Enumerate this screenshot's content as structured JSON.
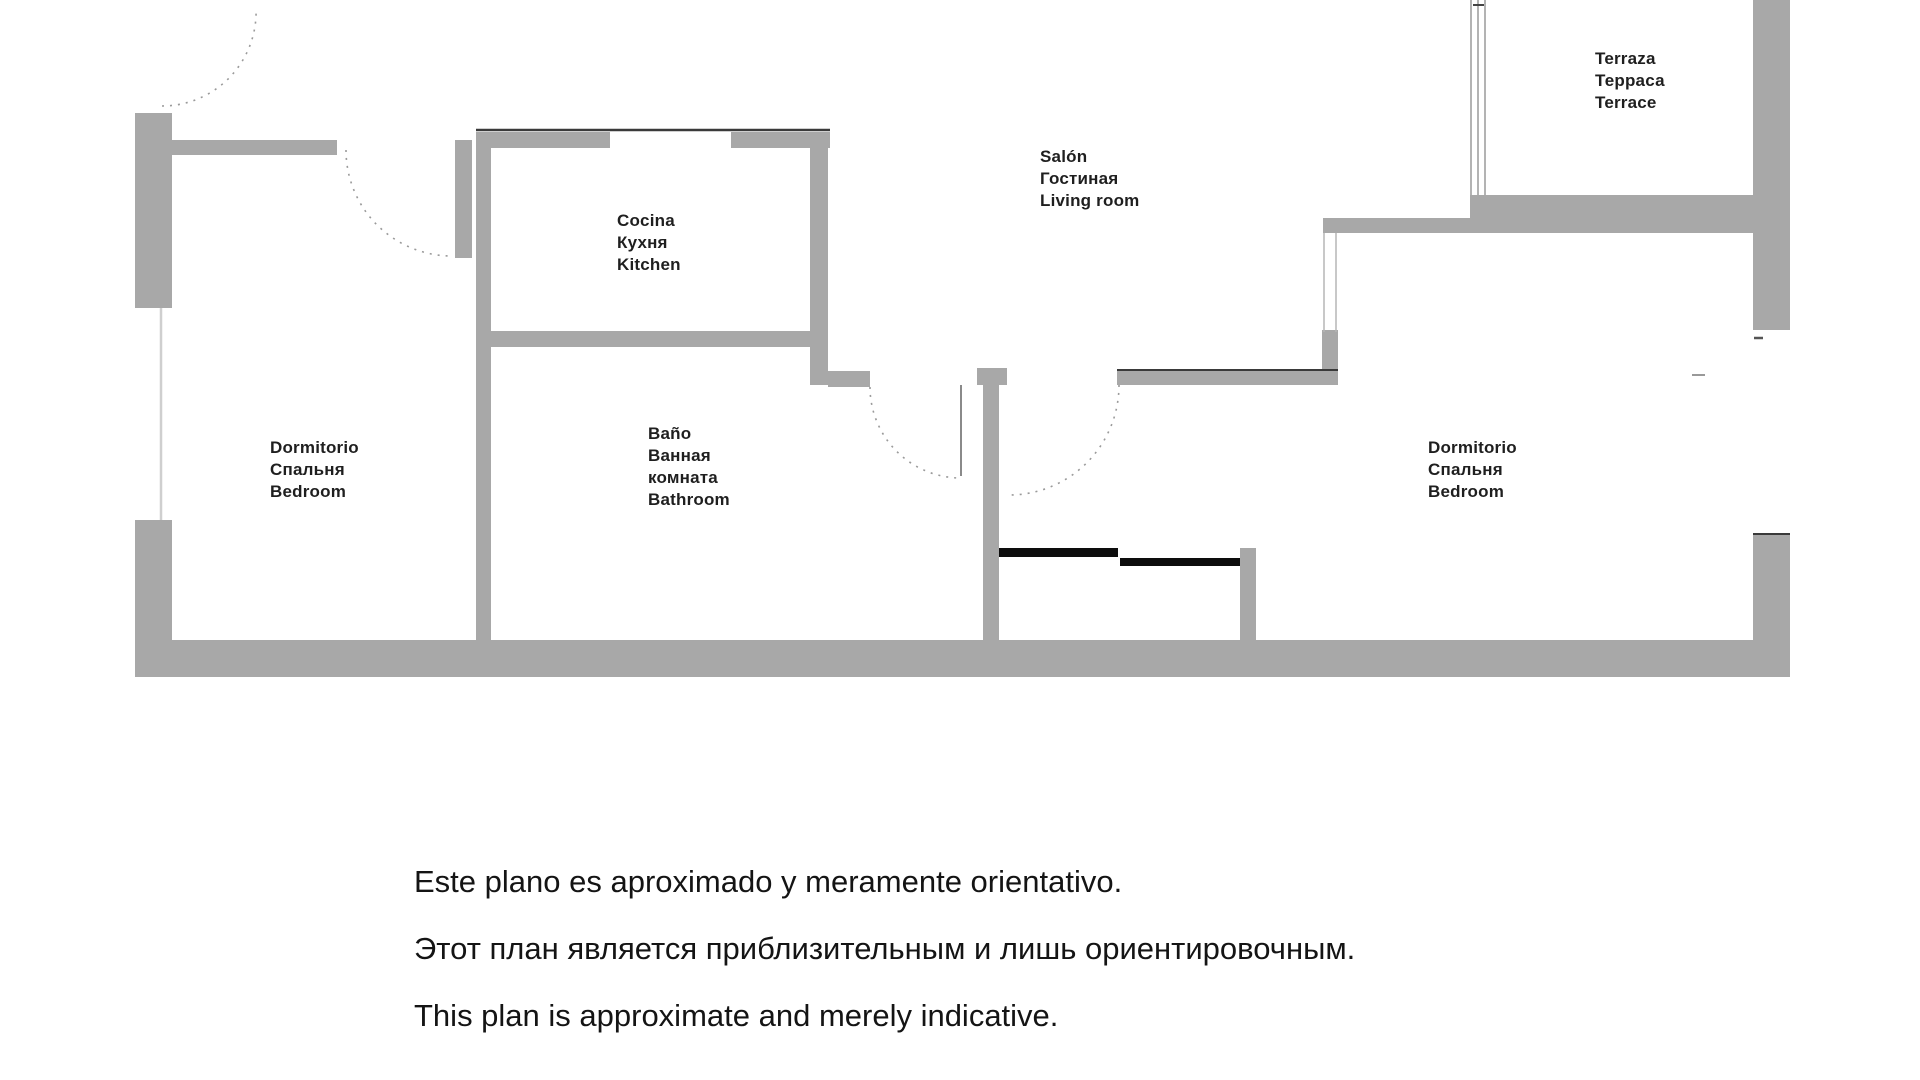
{
  "rooms": {
    "bedroom1": {
      "lines": [
        "Dormitorio",
        "Спальня",
        "Bedroom"
      ]
    },
    "kitchen": {
      "lines": [
        "Cocina",
        "Кухня",
        "Kitchen"
      ]
    },
    "bathroom": {
      "lines": [
        "Baño",
        "Ванная",
        "комната",
        "Bathroom"
      ]
    },
    "salon": {
      "lines": [
        "Salón",
        "Гостиная",
        "Living room"
      ]
    },
    "bedroom2": {
      "lines": [
        "Dormitorio",
        "Спальня",
        "Bedroom"
      ]
    },
    "terrace": {
      "lines": [
        "Terraza",
        "Терраса",
        "Terrace"
      ]
    }
  },
  "disclaimer": {
    "lines": [
      "Este plano es aproximado y meramente orientativo.",
      "Этот план является приблизительным и лишь ориентировочным.",
      "This plan is approximate and merely indicative."
    ]
  },
  "colors": {
    "background": "#ffffff",
    "wall": "#a8a8a8",
    "wall_dark_line": "#3a3a3a",
    "furniture": "#0d0d0d",
    "door_arc": "#9a9a9a",
    "window_line": "#b5b5b5",
    "label_text": "#1f1f1f",
    "disclaimer_text": "#141414"
  }
}
